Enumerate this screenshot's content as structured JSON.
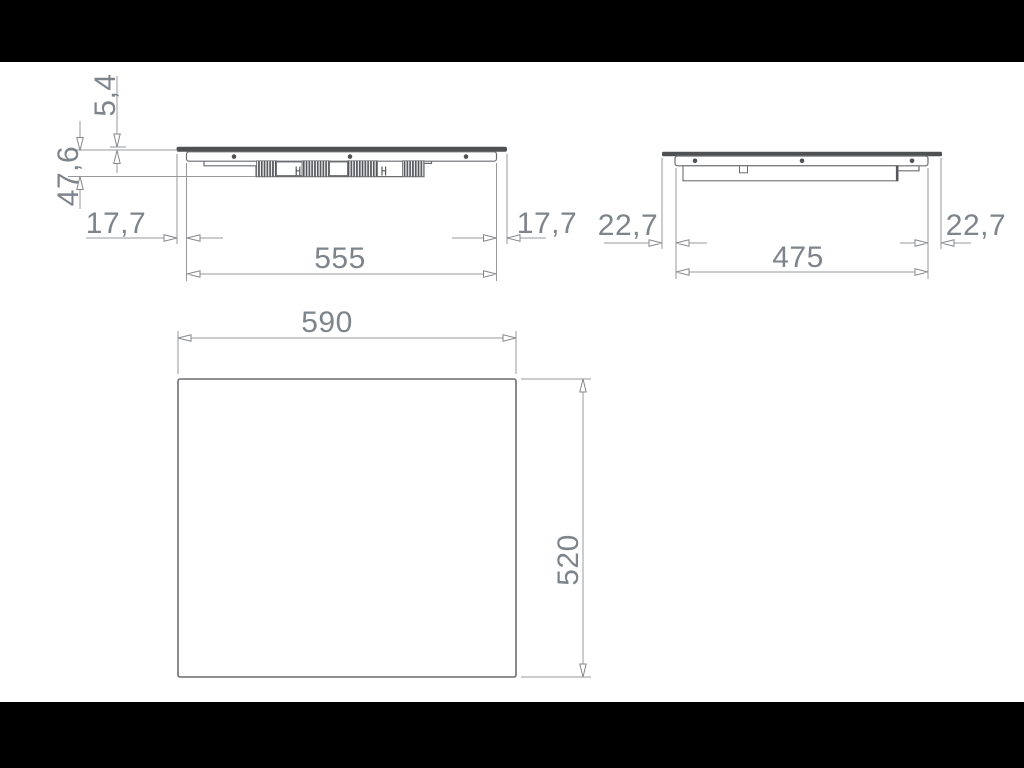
{
  "colors": {
    "background": "#ffffff",
    "letterbox": "#000000",
    "dimension_text": "#7e848c",
    "dimension_line": "#97999c",
    "drawing_outline": "#6b6d70",
    "glass_plate_fill": "#4e5052",
    "fin_hatch": "#55575a"
  },
  "front_view": {
    "plate_thickness": "5,4",
    "total_height": "47,6",
    "overhang_left": "17,7",
    "body_width": "555",
    "overhang_right": "17,7"
  },
  "side_view": {
    "overhang_left": "22,7",
    "body_depth": "475",
    "overhang_right": "22,7"
  },
  "plan_view": {
    "width": "590",
    "depth": "520"
  }
}
